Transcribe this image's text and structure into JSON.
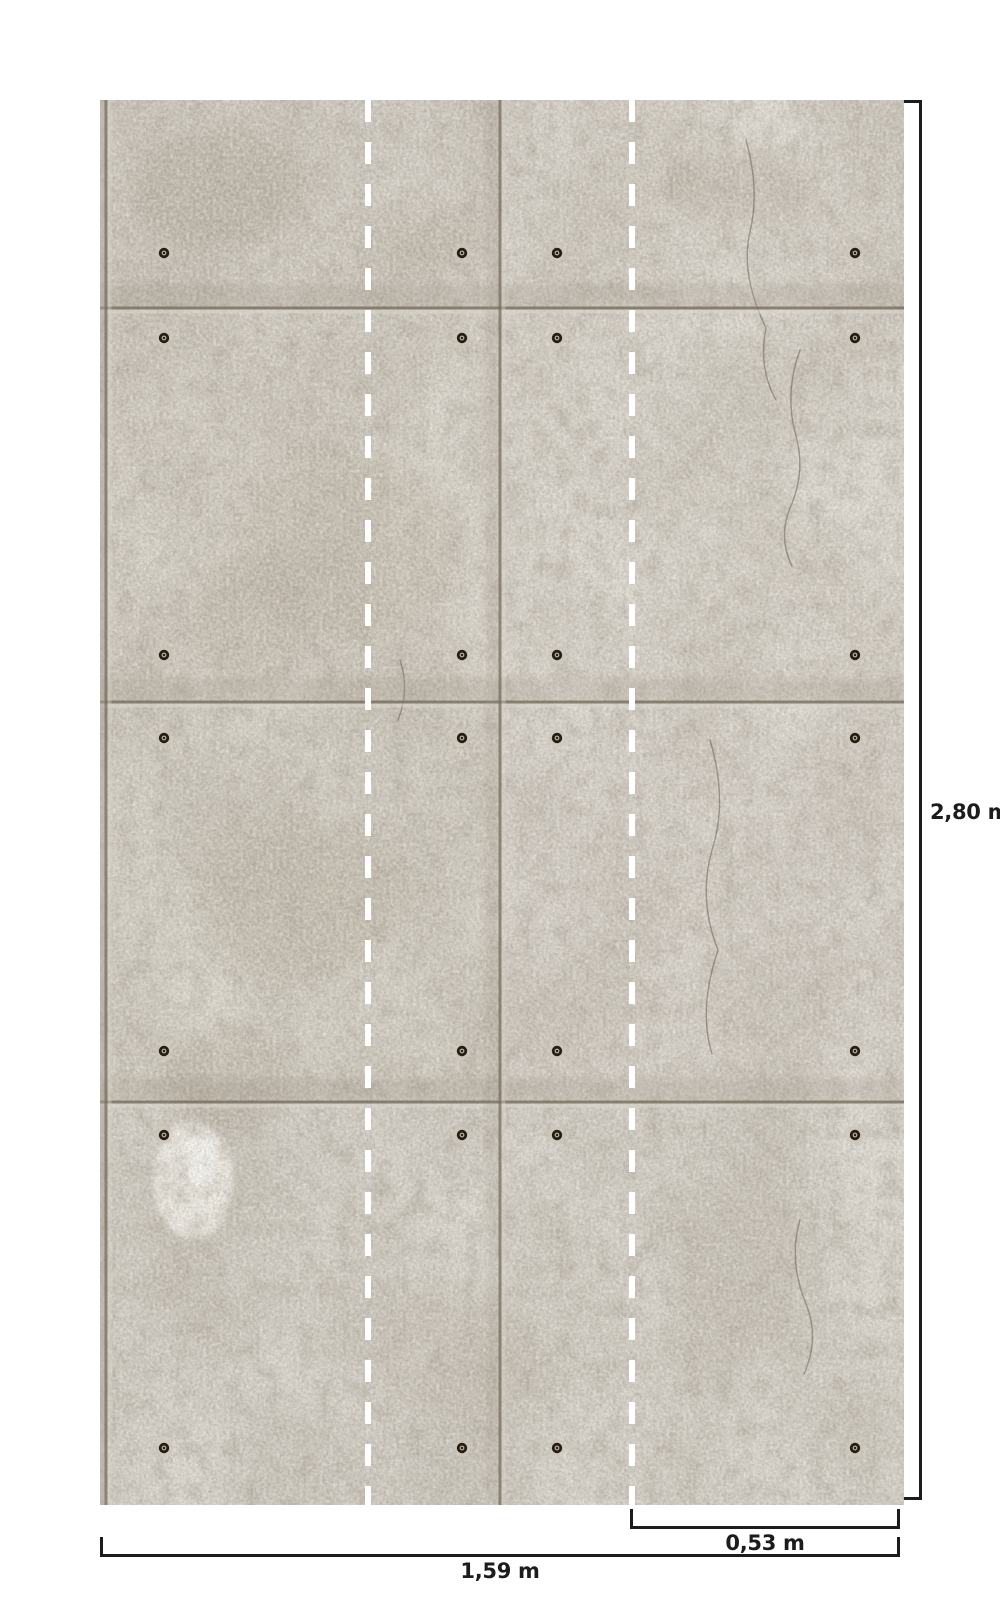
{
  "wallpaper_diagram": {
    "description": "concrete panel wallpaper mural with bolt anchors, divided into three strips by white dashed lines",
    "strip_count": 3,
    "labels": {
      "height": "2,80 m",
      "strip_width": "0,53 m",
      "total_width": "1,59 m"
    },
    "colors": {
      "background": "#ffffff",
      "dimension_line": "#1c1c1c",
      "dashed_guide": "#ffffff",
      "concrete_base": "#c6c0b6",
      "panel_seam": "#776d5e"
    }
  }
}
